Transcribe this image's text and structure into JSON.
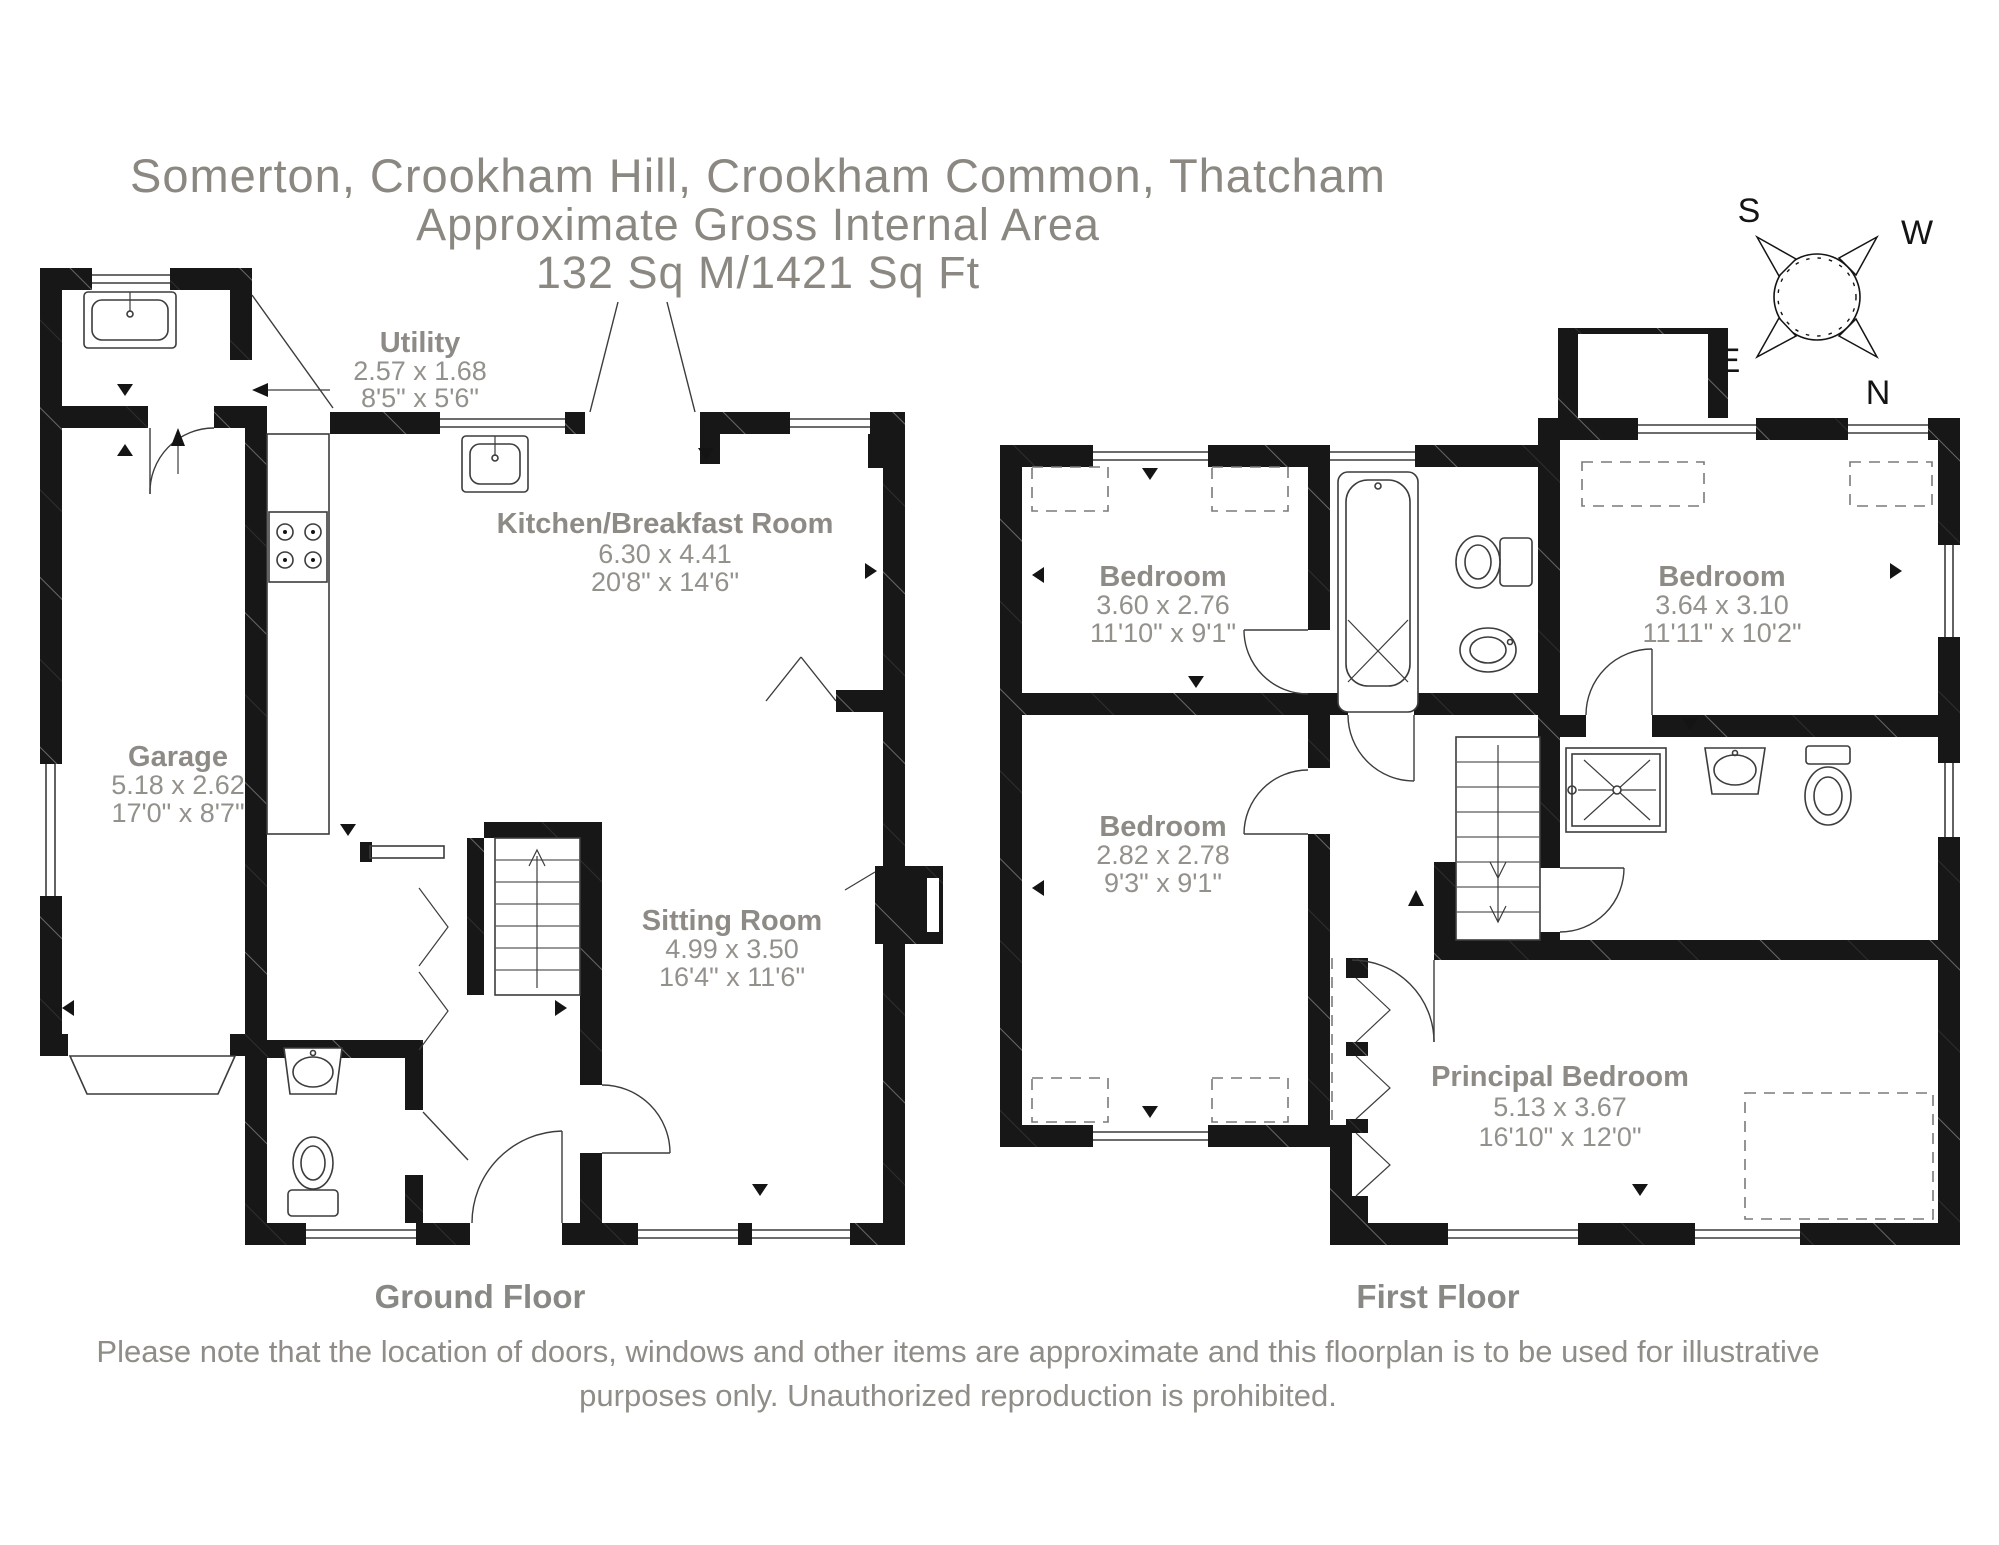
{
  "title": {
    "line1": "Somerton, Crookham Hill, Crookham Common, Thatcham",
    "line2": "Approximate Gross Internal Area",
    "line3": "132 Sq M/1421 Sq Ft"
  },
  "compass": {
    "s": "S",
    "w": "W",
    "e": "E",
    "n": "N"
  },
  "floors": [
    {
      "name": "Ground Floor",
      "rooms": [
        {
          "name": "Utility",
          "metric": "2.57 x 1.68",
          "imperial": "8'5\" x 5'6\""
        },
        {
          "name": "Kitchen/Breakfast Room",
          "metric": "6.30 x 4.41",
          "imperial": "20'8\" x 14'6\""
        },
        {
          "name": "Garage",
          "metric": "5.18 x 2.62",
          "imperial": "17'0\" x 8'7\""
        },
        {
          "name": "Sitting Room",
          "metric": "4.99 x 3.50",
          "imperial": "16'4\" x 11'6\""
        }
      ]
    },
    {
      "name": "First Floor",
      "rooms": [
        {
          "name": "Bedroom",
          "metric": "3.60 x 2.76",
          "imperial": "11'10\" x 9'1\""
        },
        {
          "name": "Bedroom",
          "metric": "3.64 x 3.10",
          "imperial": "11'11\" x 10'2\""
        },
        {
          "name": "Bedroom",
          "metric": "2.82 x 2.78",
          "imperial": "9'3\" x 9'1\""
        },
        {
          "name": "Principal Bedroom",
          "metric": "5.13 x 3.67",
          "imperial": "16'10\" x 12'0\""
        }
      ]
    }
  ],
  "disclaimer": {
    "line1": "Please note that the location of doors, windows and other items are approximate and this floorplan is to be used for illustrative",
    "line2": "purposes only. Unauthorized reproduction is prohibited."
  },
  "fixtures": [
    "sink",
    "hob",
    "staircase",
    "wc-toilet",
    "wash-basin",
    "bathtub",
    "shower",
    "fireplace",
    "compass-rose"
  ],
  "colors": {
    "wall": "#171717",
    "room_label": "#8e8b86",
    "title_text": "#8b8781",
    "detail_line": "#3c3c3c"
  }
}
